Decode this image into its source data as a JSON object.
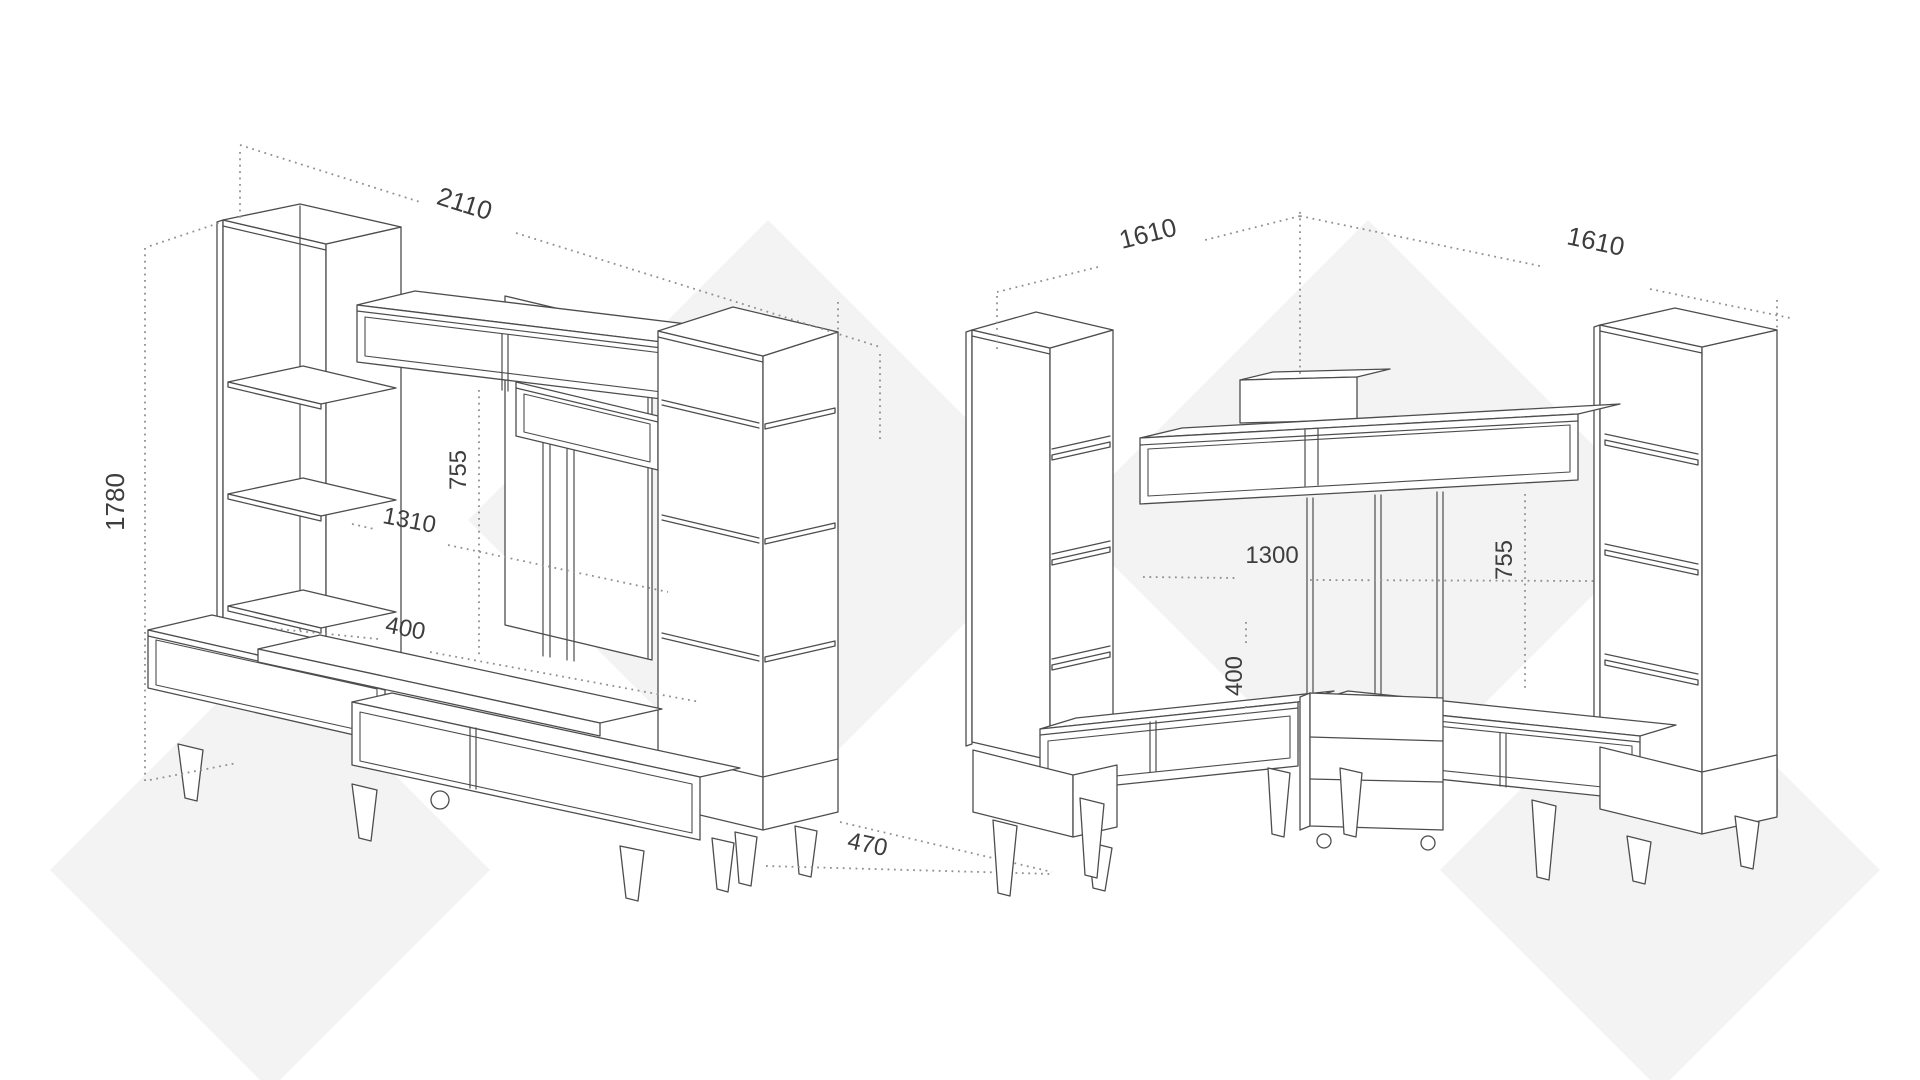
{
  "title": "Wall unit furniture technical drawings",
  "colors": {
    "background": "#ffffff",
    "watermark": "#f3f3f3",
    "line": "#4d4d4d",
    "dimension_line": "#8f8f8f",
    "dimension_text": "#3d3d3d"
  },
  "left_drawing": {
    "name": "straight wall unit",
    "dims": {
      "width": "2110",
      "height": "1780",
      "niche_height": "755",
      "niche_width": "1310",
      "bench_depth": "400",
      "depth": "470"
    }
  },
  "right_drawing": {
    "name": "corner wall unit",
    "dims": {
      "left_wall_width": "1610",
      "right_wall_width": "1610",
      "niche_width": "1300",
      "bench_height": "400",
      "niche_height": "755"
    }
  }
}
